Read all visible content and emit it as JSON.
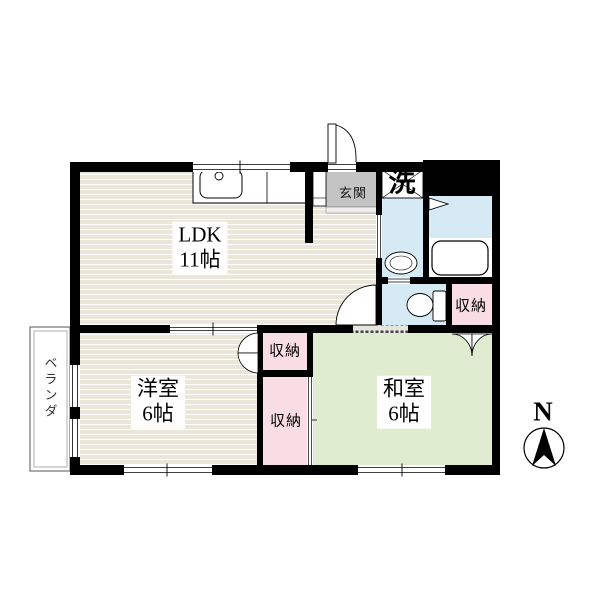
{
  "rooms": {
    "ldk": {
      "name": "LDK",
      "size": "11帖"
    },
    "western": {
      "name": "洋室",
      "size": "6帖"
    },
    "japanese": {
      "name": "和室",
      "size": "6帖"
    }
  },
  "areas": {
    "entrance": "玄関",
    "laundry": "洗",
    "veranda": "ベランダ"
  },
  "storage": {
    "hall": "収納",
    "western_upper": "収納",
    "western_lower": "収納"
  },
  "compass": {
    "north": "N"
  },
  "fixtures": [
    "kitchen-sink",
    "washing-machine-pan",
    "washbasin",
    "bathtub",
    "toilet"
  ],
  "colors": {
    "wall": "#000000",
    "wood_floor": "#eae6da",
    "tatami_green": "#e0ecd0",
    "closet_pink": "#f9dde5",
    "water_blue": "#d6eaf5",
    "entrance_gray": "#c4c4c4"
  }
}
